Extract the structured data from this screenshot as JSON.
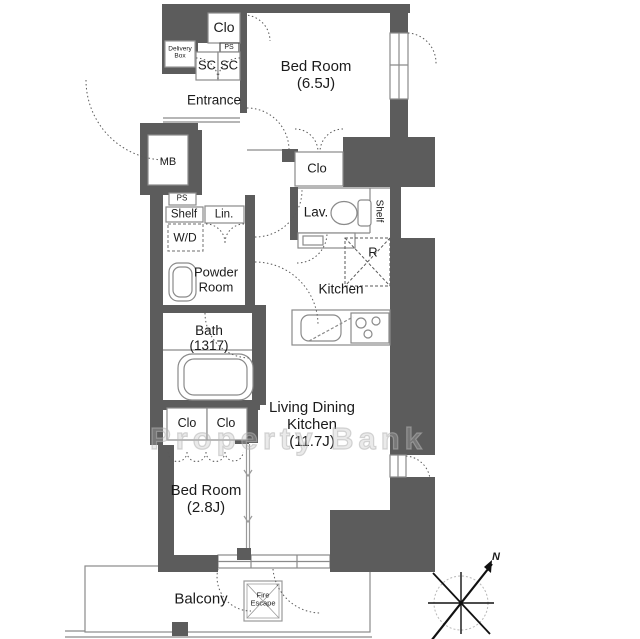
{
  "rooms": {
    "bedroom_1": {
      "name": "Bed Room",
      "size": "(6.5J)"
    },
    "bedroom_2": {
      "name": "Bed Room",
      "size": "(2.8J)"
    },
    "living_dining_kitchen": {
      "name_line1": "Living Dining",
      "name_line2": "Kitchen",
      "size": "(11.7J)"
    },
    "entrance": {
      "name": "Entrance"
    },
    "powder_room": {
      "name_line1": "Powder",
      "name_line2": "Room"
    },
    "bath": {
      "name": "Bath",
      "size": "(1317)"
    },
    "lavatory": {
      "name": "Lav."
    },
    "kitchen": {
      "name": "Kitchen"
    },
    "balcony": {
      "name": "Balcony"
    }
  },
  "fixtures": {
    "closet_top": "Clo",
    "closet_bedroom1": "Clo",
    "closet_a": "Clo",
    "closet_b": "Clo",
    "shoe_closet_1": "SC",
    "shoe_closet_2": "SC",
    "pipe_space_top": "PS",
    "pipe_space_left": "PS",
    "meter_box": "MB",
    "delivery_box_line1": "Delivery",
    "delivery_box_line2": "Box",
    "shelf_left": "Shelf",
    "shelf_right": "Shelf",
    "linen_closet": "Lin.",
    "washer_dryer": "W/D",
    "refrigerator_space": "R",
    "fire_escape_line1": "Fire",
    "fire_escape_line2": "Escape"
  },
  "annotations": {
    "watermark": "Property Bank",
    "compass_north": "N"
  },
  "colors": {
    "wall": "#5c5c5c",
    "line": "#7d7d7d",
    "text": "#1b1b1b",
    "watermark": "#c8c8c8",
    "background": "#ffffff"
  }
}
